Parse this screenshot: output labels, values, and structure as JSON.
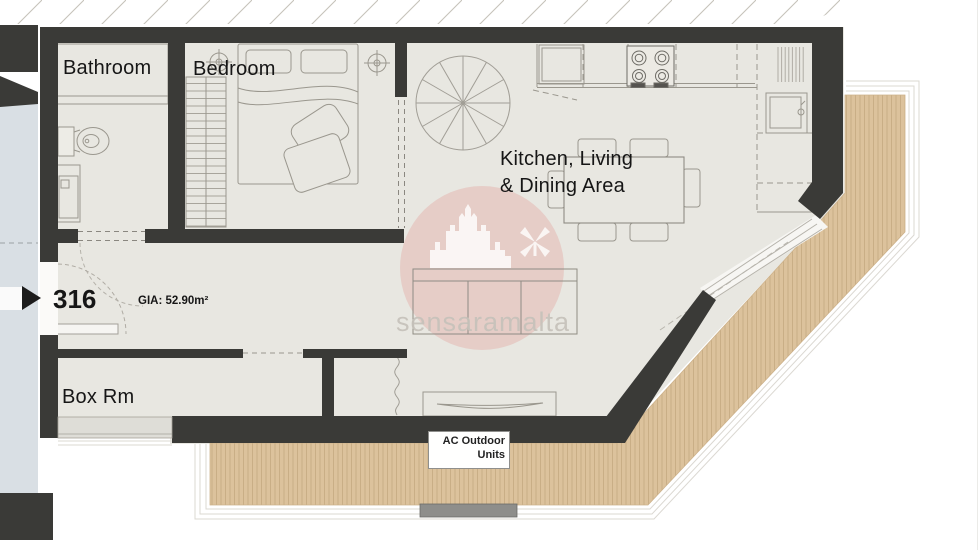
{
  "plan": {
    "unit_number": "316",
    "gia": "GIA: 52.90m²",
    "rooms": {
      "bathroom": "Bathroom",
      "bedroom": "Bedroom",
      "kitchen_living_line1": "Kitchen, Living",
      "kitchen_living_line2": "& Dining Area",
      "box_room": "Box Rm"
    },
    "labels": {
      "ac_line1": "AC Outdoor",
      "ac_line2": "Units"
    },
    "watermark": "sensaramalta",
    "colors": {
      "wall": "#3a3a37",
      "floor": "#e8e7e1",
      "deck": "#dcc29c",
      "deck_stripe": "#c9ae86",
      "corridor": "#d9dfe4",
      "watermark_pink": "#e2aaa4",
      "watermark_text": "#c6c2ba"
    }
  }
}
